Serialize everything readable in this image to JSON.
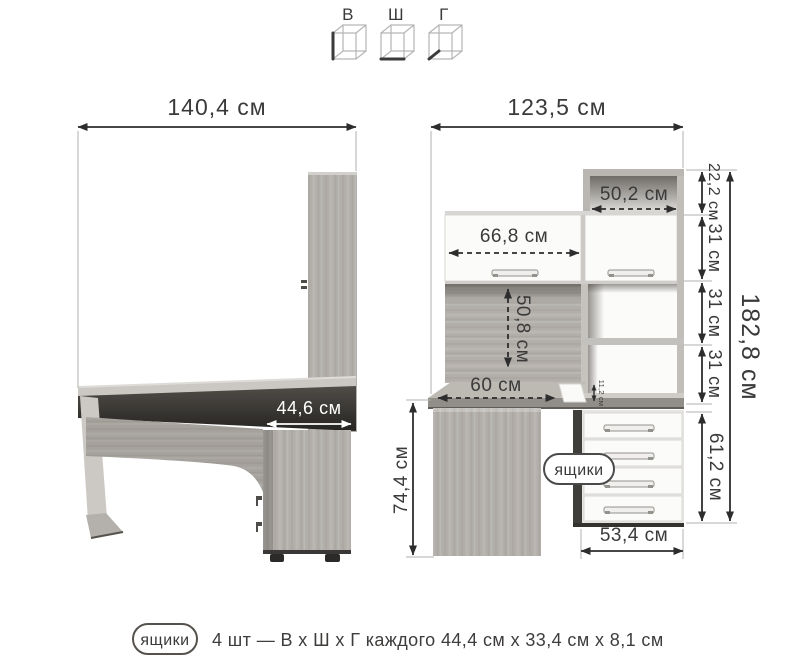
{
  "legend": {
    "items": [
      {
        "label": "В",
        "icon": "cube-height-icon"
      },
      {
        "label": "Ш",
        "icon": "cube-width-icon"
      },
      {
        "label": "Г",
        "icon": "cube-depth-icon"
      }
    ]
  },
  "side_view": {
    "width_label": "140,4 см",
    "unit_depth_label": "44,6 см"
  },
  "front_view": {
    "width_label": "123,5 см",
    "top_shelf_width_label": "50,2 см",
    "top_section_height_label": "22,2 см",
    "door_width_label": "66,8 см",
    "shelf_heights": [
      "31 см",
      "31 см",
      "31 см"
    ],
    "total_height_label": "182,8 см",
    "back_panel_height_label": "50,8 см",
    "desktop_depth_label": "60 см",
    "riser_height_label": "11,2 см",
    "desk_height_label": "74,4 см",
    "drawers_height_label": "61,2 см",
    "drawers_width_label": "53,4 см",
    "drawers_callout": "ящики"
  },
  "caption": {
    "badge": "ящики",
    "text": "4 шт — В х Ш х Г каждого 44,4 см х 33,4 см х 8,1 см"
  },
  "colors": {
    "dimension": "#2d2d2d",
    "wood": "#b2afaa",
    "dark_edge": "#33312e",
    "front_white": "#fbfbfa"
  }
}
